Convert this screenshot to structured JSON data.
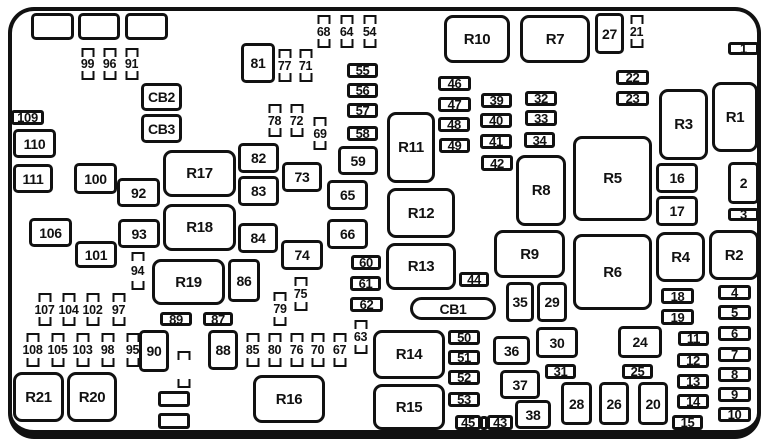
{
  "diagram": {
    "kind": "fuse-box-layout",
    "colors": {
      "line": "#111111",
      "background": "#ffffff"
    },
    "elements": [
      {
        "type": "box",
        "label": "",
        "x": 31,
        "y": 13,
        "w": 43,
        "h": 27
      },
      {
        "type": "box",
        "label": "",
        "x": 78,
        "y": 13,
        "w": 42,
        "h": 27
      },
      {
        "type": "box",
        "label": "",
        "x": 125,
        "y": 13,
        "w": 43,
        "h": 27
      },
      {
        "type": "fuse",
        "label": "99",
        "x": 80,
        "y": 48,
        "w": 15,
        "h": 32
      },
      {
        "type": "fuse",
        "label": "96",
        "x": 102,
        "y": 48,
        "w": 15,
        "h": 32
      },
      {
        "type": "fuse",
        "label": "91",
        "x": 124,
        "y": 48,
        "w": 15,
        "h": 32
      },
      {
        "type": "box",
        "label": "CB2",
        "x": 141,
        "y": 83,
        "w": 41,
        "h": 28
      },
      {
        "type": "box",
        "label": "CB3",
        "x": 141,
        "y": 114,
        "w": 41,
        "h": 29
      },
      {
        "type": "hbox",
        "label": "109",
        "x": 11,
        "y": 110,
        "w": 33,
        "h": 15
      },
      {
        "type": "box",
        "label": "110",
        "x": 13,
        "y": 129,
        "w": 43,
        "h": 29
      },
      {
        "type": "box",
        "label": "111",
        "x": 13,
        "y": 164,
        "w": 40,
        "h": 29
      },
      {
        "type": "box",
        "label": "100",
        "x": 74,
        "y": 163,
        "w": 43,
        "h": 31
      },
      {
        "type": "box",
        "label": "92",
        "x": 117,
        "y": 178,
        "w": 43,
        "h": 29
      },
      {
        "type": "box",
        "label": "106",
        "x": 29,
        "y": 218,
        "w": 43,
        "h": 29
      },
      {
        "type": "box",
        "label": "93",
        "x": 118,
        "y": 219,
        "w": 42,
        "h": 29
      },
      {
        "type": "box",
        "label": "101",
        "x": 75,
        "y": 241,
        "w": 42,
        "h": 27
      },
      {
        "type": "fuse",
        "label": "94",
        "x": 129,
        "y": 252,
        "w": 17,
        "h": 38
      },
      {
        "type": "relay",
        "label": "R17",
        "x": 163,
        "y": 150,
        "w": 73,
        "h": 47
      },
      {
        "type": "relay",
        "label": "R18",
        "x": 163,
        "y": 204,
        "w": 73,
        "h": 47
      },
      {
        "type": "relay",
        "label": "R19",
        "x": 152,
        "y": 259,
        "w": 73,
        "h": 46
      },
      {
        "type": "box",
        "label": "86",
        "x": 228,
        "y": 259,
        "w": 32,
        "h": 43
      },
      {
        "type": "box",
        "label": "81",
        "x": 241,
        "y": 43,
        "w": 34,
        "h": 40
      },
      {
        "type": "fuse",
        "label": "77",
        "x": 277,
        "y": 49,
        "w": 15,
        "h": 33
      },
      {
        "type": "fuse",
        "label": "71",
        "x": 298,
        "y": 49,
        "w": 15,
        "h": 33
      },
      {
        "type": "fuse",
        "label": "68",
        "x": 316,
        "y": 15,
        "w": 15,
        "h": 33
      },
      {
        "type": "fuse",
        "label": "64",
        "x": 339,
        "y": 15,
        "w": 15,
        "h": 33
      },
      {
        "type": "fuse",
        "label": "54",
        "x": 362,
        "y": 15,
        "w": 15,
        "h": 33
      },
      {
        "type": "fuse",
        "label": "78",
        "x": 267,
        "y": 104,
        "w": 15,
        "h": 33
      },
      {
        "type": "fuse",
        "label": "72",
        "x": 289,
        "y": 104,
        "w": 15,
        "h": 33
      },
      {
        "type": "fuse",
        "label": "69",
        "x": 312,
        "y": 117,
        "w": 16,
        "h": 33
      },
      {
        "type": "hbox",
        "label": "55",
        "x": 347,
        "y": 63,
        "w": 31,
        "h": 15
      },
      {
        "type": "hbox",
        "label": "56",
        "x": 347,
        "y": 83,
        "w": 31,
        "h": 15
      },
      {
        "type": "hbox",
        "label": "57",
        "x": 347,
        "y": 103,
        "w": 31,
        "h": 15
      },
      {
        "type": "hbox",
        "label": "58",
        "x": 347,
        "y": 126,
        "w": 31,
        "h": 15
      },
      {
        "type": "box",
        "label": "59",
        "x": 338,
        "y": 146,
        "w": 40,
        "h": 29
      },
      {
        "type": "box",
        "label": "82",
        "x": 238,
        "y": 143,
        "w": 41,
        "h": 30
      },
      {
        "type": "box",
        "label": "83",
        "x": 238,
        "y": 176,
        "w": 41,
        "h": 30
      },
      {
        "type": "box",
        "label": "73",
        "x": 282,
        "y": 162,
        "w": 40,
        "h": 30
      },
      {
        "type": "box",
        "label": "84",
        "x": 238,
        "y": 223,
        "w": 40,
        "h": 30
      },
      {
        "type": "box",
        "label": "74",
        "x": 281,
        "y": 240,
        "w": 42,
        "h": 30
      },
      {
        "type": "box",
        "label": "65",
        "x": 327,
        "y": 180,
        "w": 41,
        "h": 30
      },
      {
        "type": "box",
        "label": "66",
        "x": 327,
        "y": 219,
        "w": 41,
        "h": 30
      },
      {
        "type": "relay",
        "label": "R11",
        "x": 387,
        "y": 112,
        "w": 48,
        "h": 71
      },
      {
        "type": "relay",
        "label": "R12",
        "x": 387,
        "y": 188,
        "w": 68,
        "h": 50
      },
      {
        "type": "relay",
        "label": "R13",
        "x": 386,
        "y": 243,
        "w": 70,
        "h": 47
      },
      {
        "type": "hbox",
        "label": "60",
        "x": 351,
        "y": 255,
        "w": 30,
        "h": 15
      },
      {
        "type": "hbox",
        "label": "61",
        "x": 350,
        "y": 276,
        "w": 31,
        "h": 15
      },
      {
        "type": "hbox",
        "label": "62",
        "x": 350,
        "y": 297,
        "w": 33,
        "h": 15
      },
      {
        "type": "fuse",
        "label": "75",
        "x": 293,
        "y": 277,
        "w": 15,
        "h": 34
      },
      {
        "type": "fuse",
        "label": "79",
        "x": 272,
        "y": 292,
        "w": 16,
        "h": 34
      },
      {
        "type": "fuse",
        "label": "63",
        "x": 352,
        "y": 320,
        "w": 17,
        "h": 34
      },
      {
        "type": "relay",
        "label": "R10",
        "x": 444,
        "y": 15,
        "w": 66,
        "h": 48
      },
      {
        "type": "relay",
        "label": "R7",
        "x": 520,
        "y": 15,
        "w": 70,
        "h": 48
      },
      {
        "type": "box",
        "label": "27",
        "x": 595,
        "y": 13,
        "w": 29,
        "h": 41
      },
      {
        "type": "fuse",
        "label": "21",
        "x": 628,
        "y": 15,
        "w": 17,
        "h": 33
      },
      {
        "type": "hbox",
        "label": "1",
        "x": 728,
        "y": 42,
        "w": 31,
        "h": 13
      },
      {
        "type": "hbox",
        "label": "22",
        "x": 616,
        "y": 70,
        "w": 33,
        "h": 15
      },
      {
        "type": "hbox",
        "label": "23",
        "x": 616,
        "y": 91,
        "w": 33,
        "h": 15
      },
      {
        "type": "hbox",
        "label": "46",
        "x": 438,
        "y": 76,
        "w": 33,
        "h": 15
      },
      {
        "type": "hbox",
        "label": "47",
        "x": 438,
        "y": 97,
        "w": 33,
        "h": 15
      },
      {
        "type": "hbox",
        "label": "48",
        "x": 438,
        "y": 117,
        "w": 32,
        "h": 15
      },
      {
        "type": "hbox",
        "label": "49",
        "x": 439,
        "y": 138,
        "w": 31,
        "h": 15
      },
      {
        "type": "hbox",
        "label": "39",
        "x": 481,
        "y": 93,
        "w": 31,
        "h": 15
      },
      {
        "type": "hbox",
        "label": "40",
        "x": 480,
        "y": 113,
        "w": 32,
        "h": 15
      },
      {
        "type": "hbox",
        "label": "41",
        "x": 480,
        "y": 134,
        "w": 32,
        "h": 15
      },
      {
        "type": "hbox",
        "label": "42",
        "x": 481,
        "y": 155,
        "w": 32,
        "h": 16
      },
      {
        "type": "hbox",
        "label": "32",
        "x": 525,
        "y": 91,
        "w": 32,
        "h": 15
      },
      {
        "type": "hbox",
        "label": "33",
        "x": 525,
        "y": 110,
        "w": 32,
        "h": 16
      },
      {
        "type": "hbox",
        "label": "34",
        "x": 524,
        "y": 132,
        "w": 31,
        "h": 16
      },
      {
        "type": "relay",
        "label": "R3",
        "x": 659,
        "y": 89,
        "w": 49,
        "h": 71
      },
      {
        "type": "relay",
        "label": "R1",
        "x": 712,
        "y": 82,
        "w": 46,
        "h": 70
      },
      {
        "type": "relay",
        "label": "R8",
        "x": 516,
        "y": 155,
        "w": 50,
        "h": 71
      },
      {
        "type": "relay",
        "label": "R5",
        "x": 573,
        "y": 136,
        "w": 79,
        "h": 85
      },
      {
        "type": "box",
        "label": "16",
        "x": 656,
        "y": 163,
        "w": 42,
        "h": 30
      },
      {
        "type": "box",
        "label": "17",
        "x": 656,
        "y": 196,
        "w": 42,
        "h": 30
      },
      {
        "type": "box",
        "label": "2",
        "x": 728,
        "y": 162,
        "w": 31,
        "h": 42
      },
      {
        "type": "hbox",
        "label": "3",
        "x": 728,
        "y": 208,
        "w": 31,
        "h": 13
      },
      {
        "type": "relay",
        "label": "R9",
        "x": 494,
        "y": 230,
        "w": 71,
        "h": 48
      },
      {
        "type": "relay",
        "label": "R6",
        "x": 573,
        "y": 234,
        "w": 79,
        "h": 76
      },
      {
        "type": "relay",
        "label": "R4",
        "x": 656,
        "y": 232,
        "w": 49,
        "h": 50
      },
      {
        "type": "relay",
        "label": "R2",
        "x": 709,
        "y": 230,
        "w": 50,
        "h": 50
      },
      {
        "type": "hbox",
        "label": "44",
        "x": 459,
        "y": 272,
        "w": 30,
        "h": 15
      },
      {
        "type": "box",
        "label": "35",
        "x": 506,
        "y": 282,
        "w": 28,
        "h": 40
      },
      {
        "type": "box",
        "label": "29",
        "x": 537,
        "y": 282,
        "w": 30,
        "h": 40
      },
      {
        "type": "pill",
        "label": "CB1",
        "x": 410,
        "y": 297,
        "w": 86,
        "h": 23
      },
      {
        "type": "hbox",
        "label": "18",
        "x": 661,
        "y": 288,
        "w": 33,
        "h": 16
      },
      {
        "type": "hbox",
        "label": "19",
        "x": 661,
        "y": 309,
        "w": 33,
        "h": 16
      },
      {
        "type": "hbox",
        "label": "4",
        "x": 718,
        "y": 285,
        "w": 33,
        "h": 15
      },
      {
        "type": "hbox",
        "label": "5",
        "x": 718,
        "y": 305,
        "w": 33,
        "h": 15
      },
      {
        "type": "hbox",
        "label": "6",
        "x": 718,
        "y": 326,
        "w": 33,
        "h": 15
      },
      {
        "type": "hbox",
        "label": "7",
        "x": 718,
        "y": 347,
        "w": 33,
        "h": 15
      },
      {
        "type": "hbox",
        "label": "8",
        "x": 718,
        "y": 367,
        "w": 33,
        "h": 15
      },
      {
        "type": "hbox",
        "label": "9",
        "x": 718,
        "y": 387,
        "w": 33,
        "h": 15
      },
      {
        "type": "hbox",
        "label": "10",
        "x": 718,
        "y": 407,
        "w": 33,
        "h": 15
      },
      {
        "type": "hbox",
        "label": "11",
        "x": 678,
        "y": 331,
        "w": 31,
        "h": 15
      },
      {
        "type": "hbox",
        "label": "12",
        "x": 677,
        "y": 353,
        "w": 32,
        "h": 15
      },
      {
        "type": "hbox",
        "label": "13",
        "x": 677,
        "y": 374,
        "w": 32,
        "h": 15
      },
      {
        "type": "hbox",
        "label": "14",
        "x": 677,
        "y": 394,
        "w": 32,
        "h": 15
      },
      {
        "type": "hbox",
        "label": "15",
        "x": 672,
        "y": 415,
        "w": 31,
        "h": 15
      },
      {
        "type": "fuse",
        "label": "107",
        "x": 37,
        "y": 293,
        "w": 15,
        "h": 33
      },
      {
        "type": "fuse",
        "label": "104",
        "x": 61,
        "y": 293,
        "w": 15,
        "h": 33
      },
      {
        "type": "fuse",
        "label": "102",
        "x": 85,
        "y": 293,
        "w": 15,
        "h": 33
      },
      {
        "type": "fuse",
        "label": "97",
        "x": 111,
        "y": 293,
        "w": 15,
        "h": 33
      },
      {
        "type": "fuse",
        "label": "108",
        "x": 25,
        "y": 333,
        "w": 15,
        "h": 34
      },
      {
        "type": "fuse",
        "label": "105",
        "x": 50,
        "y": 333,
        "w": 15,
        "h": 34
      },
      {
        "type": "fuse",
        "label": "103",
        "x": 75,
        "y": 333,
        "w": 15,
        "h": 34
      },
      {
        "type": "fuse",
        "label": "98",
        "x": 100,
        "y": 333,
        "w": 15,
        "h": 34
      },
      {
        "type": "fuse",
        "label": "95",
        "x": 125,
        "y": 333,
        "w": 15,
        "h": 34
      },
      {
        "type": "hbox",
        "label": "89",
        "x": 160,
        "y": 312,
        "w": 32,
        "h": 14
      },
      {
        "type": "hbox",
        "label": "87",
        "x": 203,
        "y": 312,
        "w": 30,
        "h": 14
      },
      {
        "type": "box",
        "label": "90",
        "x": 139,
        "y": 330,
        "w": 30,
        "h": 42
      },
      {
        "type": "box",
        "label": "88",
        "x": 208,
        "y": 330,
        "w": 30,
        "h": 40
      },
      {
        "type": "fuse",
        "label": "",
        "x": 175,
        "y": 351,
        "w": 17,
        "h": 37
      },
      {
        "type": "hbox",
        "label": "",
        "x": 158,
        "y": 391,
        "w": 32,
        "h": 16
      },
      {
        "type": "hbox",
        "label": "",
        "x": 158,
        "y": 413,
        "w": 32,
        "h": 16
      },
      {
        "type": "fuse",
        "label": "85",
        "x": 245,
        "y": 333,
        "w": 15,
        "h": 34
      },
      {
        "type": "fuse",
        "label": "80",
        "x": 267,
        "y": 333,
        "w": 15,
        "h": 34
      },
      {
        "type": "fuse",
        "label": "76",
        "x": 289,
        "y": 333,
        "w": 15,
        "h": 34
      },
      {
        "type": "fuse",
        "label": "70",
        "x": 310,
        "y": 333,
        "w": 15,
        "h": 34
      },
      {
        "type": "fuse",
        "label": "67",
        "x": 332,
        "y": 333,
        "w": 15,
        "h": 34
      },
      {
        "type": "relay",
        "label": "R21",
        "x": 13,
        "y": 372,
        "w": 51,
        "h": 50
      },
      {
        "type": "relay",
        "label": "R20",
        "x": 67,
        "y": 372,
        "w": 50,
        "h": 50
      },
      {
        "type": "relay",
        "label": "R16",
        "x": 253,
        "y": 375,
        "w": 72,
        "h": 48
      },
      {
        "type": "relay",
        "label": "R14",
        "x": 373,
        "y": 330,
        "w": 72,
        "h": 49
      },
      {
        "type": "relay",
        "label": "R15",
        "x": 373,
        "y": 384,
        "w": 72,
        "h": 46
      },
      {
        "type": "hbox",
        "label": "50",
        "x": 448,
        "y": 330,
        "w": 32,
        "h": 15
      },
      {
        "type": "hbox",
        "label": "51",
        "x": 448,
        "y": 350,
        "w": 32,
        "h": 15
      },
      {
        "type": "hbox",
        "label": "52",
        "x": 448,
        "y": 370,
        "w": 32,
        "h": 15
      },
      {
        "type": "hbox",
        "label": "53",
        "x": 448,
        "y": 392,
        "w": 32,
        "h": 15
      },
      {
        "type": "hbox",
        "label": "45",
        "x": 455,
        "y": 415,
        "w": 26,
        "h": 15
      },
      {
        "type": "hbox",
        "label": "",
        "x": 480,
        "y": 416,
        "w": 8,
        "h": 14
      },
      {
        "type": "hbox",
        "label": "43",
        "x": 487,
        "y": 415,
        "w": 26,
        "h": 15
      },
      {
        "type": "box",
        "label": "36",
        "x": 493,
        "y": 336,
        "w": 37,
        "h": 29
      },
      {
        "type": "box",
        "label": "37",
        "x": 500,
        "y": 370,
        "w": 40,
        "h": 29
      },
      {
        "type": "box",
        "label": "38",
        "x": 515,
        "y": 400,
        "w": 36,
        "h": 29
      },
      {
        "type": "box",
        "label": "30",
        "x": 536,
        "y": 327,
        "w": 42,
        "h": 31
      },
      {
        "type": "hbox",
        "label": "31",
        "x": 545,
        "y": 364,
        "w": 31,
        "h": 15
      },
      {
        "type": "box",
        "label": "24",
        "x": 618,
        "y": 326,
        "w": 44,
        "h": 32
      },
      {
        "type": "hbox",
        "label": "25",
        "x": 622,
        "y": 364,
        "w": 31,
        "h": 15
      },
      {
        "type": "box",
        "label": "28",
        "x": 561,
        "y": 382,
        "w": 31,
        "h": 43
      },
      {
        "type": "box",
        "label": "26",
        "x": 599,
        "y": 382,
        "w": 30,
        "h": 43
      },
      {
        "type": "box",
        "label": "20",
        "x": 638,
        "y": 382,
        "w": 30,
        "h": 43
      }
    ]
  }
}
